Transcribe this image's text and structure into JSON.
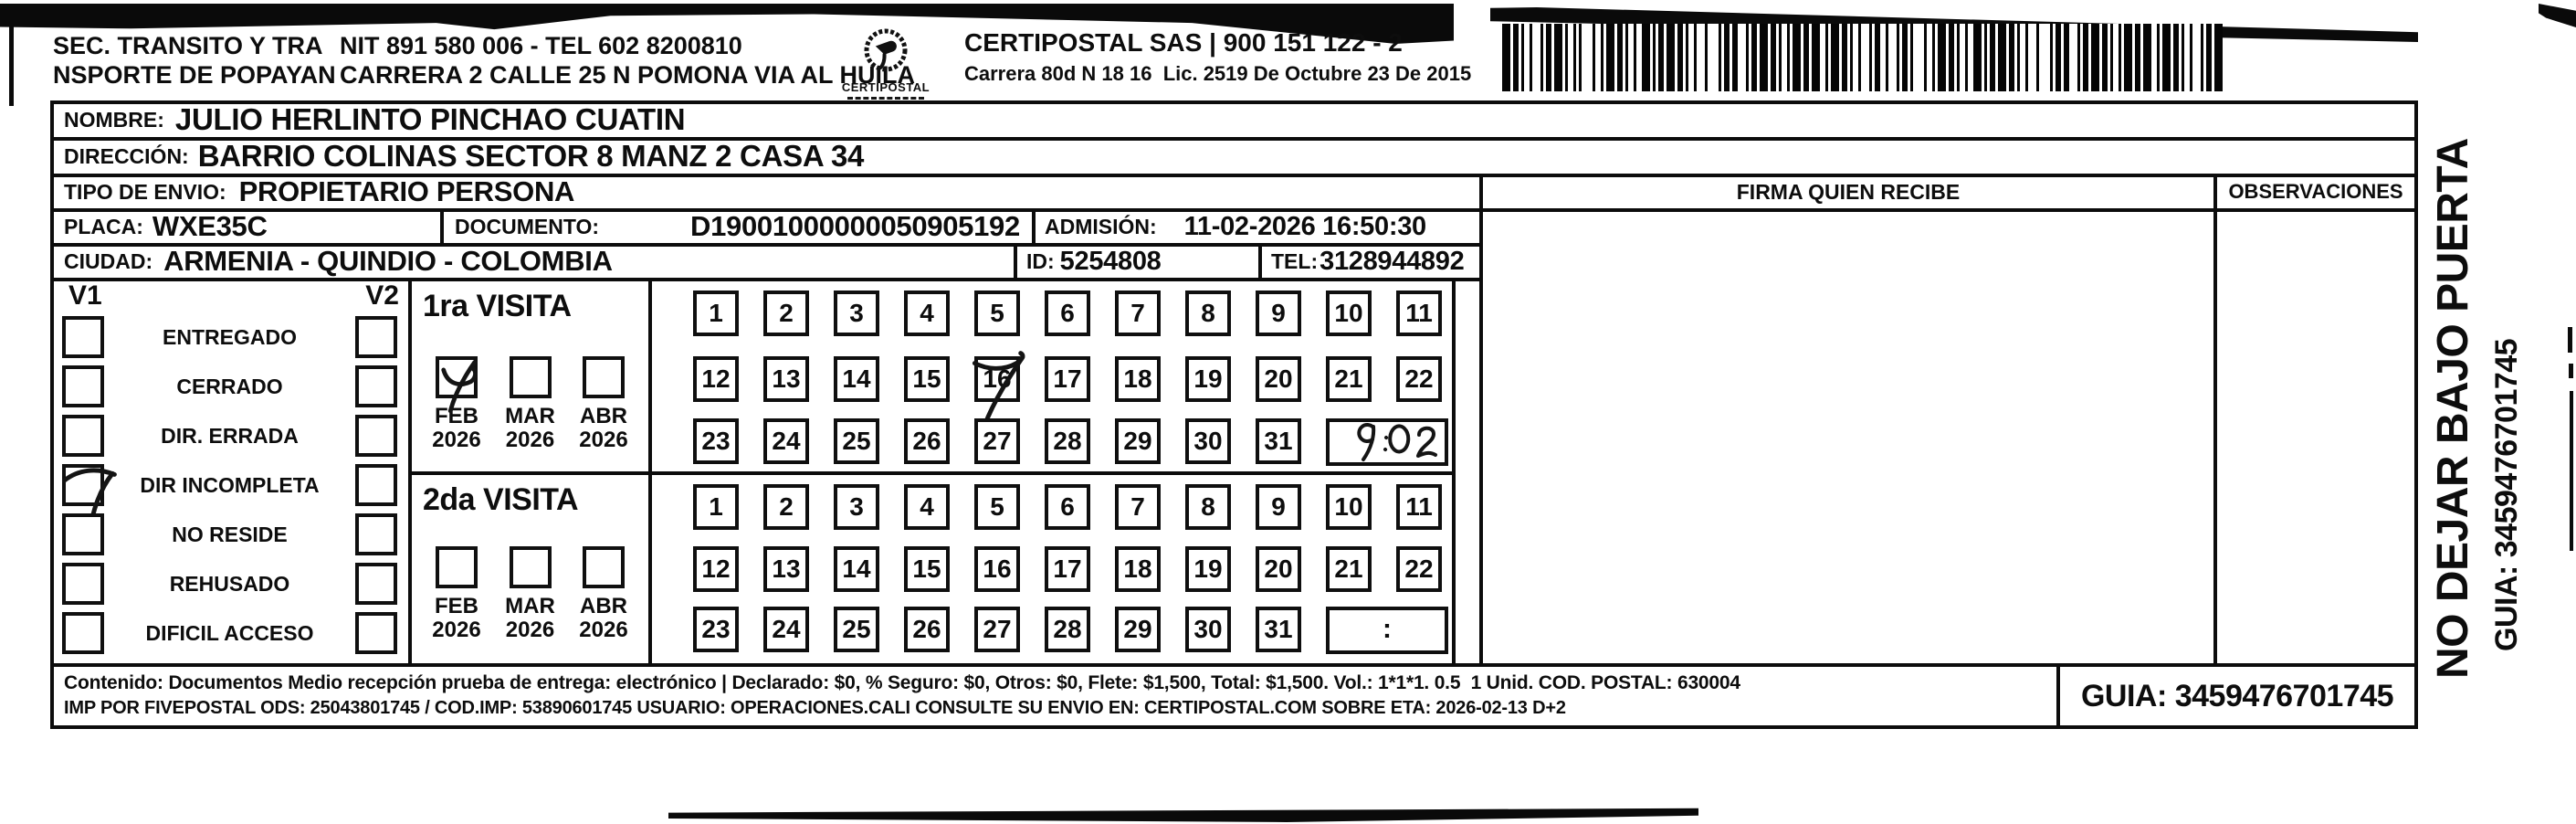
{
  "header": {
    "sender_name": "SEC. TRANSITO Y TRA\nNSPORTE DE POPAYAN",
    "sender_nit_tel": "NIT 891 580 006 - TEL 602 8200810",
    "sender_address": "CARRERA 2 CALLE 25 N POMONA VIA AL HUILA",
    "logo_text": "CERTIPOSTAL",
    "carrier_title": "CERTIPOSTAL SAS | 900 151 122 - 2",
    "carrier_address": "Carrera 80d N 18 16  Lic. 2519 De Octubre 23 De 2015"
  },
  "shipment": {
    "nombre_label": "NOMBRE:",
    "nombre": "JULIO HERLINTO PINCHAO CUATIN",
    "direccion_label": "DIRECCIÓN:",
    "direccion": "BARRIO COLINAS SECTOR 8 MANZ 2 CASA 34",
    "tipo_label": "TIPO DE ENVIO:",
    "tipo": "PROPIETARIO PERSONA",
    "placa_label": "PLACA:",
    "placa": "WXE35C",
    "documento_label": "DOCUMENTO:",
    "documento": "D19001000000050905192",
    "admision_label": "ADMISIÓN:",
    "admision": "11-02-2026 16:50:30",
    "ciudad_label": "CIUDAD:",
    "ciudad": "ARMENIA - QUINDIO - COLOMBIA",
    "id_label": "ID:",
    "id_value": "5254808",
    "tel_label": "TEL:",
    "tel": "3128944892"
  },
  "columns": {
    "firma": "FIRMA QUIEN RECIBE",
    "observaciones": "OBSERVACIONES"
  },
  "delivery_status": {
    "col1_header": "V1",
    "col2_header": "V2",
    "rows": [
      {
        "label": "ENTREGADO",
        "v1_marked": false,
        "v2_marked": false
      },
      {
        "label": "CERRADO",
        "v1_marked": false,
        "v2_marked": false
      },
      {
        "label": "DIR. ERRADA",
        "v1_marked": false,
        "v2_marked": false
      },
      {
        "label": "DIR INCOMPLETA",
        "v1_marked": true,
        "v2_marked": false
      },
      {
        "label": "NO RESIDE",
        "v1_marked": false,
        "v2_marked": false
      },
      {
        "label": "REHUSADO",
        "v1_marked": false,
        "v2_marked": false
      },
      {
        "label": "DIFICIL ACCESO",
        "v1_marked": false,
        "v2_marked": false
      }
    ]
  },
  "visits": [
    {
      "title": "1ra VISITA",
      "months": [
        {
          "month": "FEB",
          "year": "2026",
          "marked": true
        },
        {
          "month": "MAR",
          "year": "2026",
          "marked": false
        },
        {
          "month": "ABR",
          "year": "2026",
          "marked": false
        }
      ],
      "day_rows": [
        [
          1,
          2,
          3,
          4,
          5,
          6,
          7,
          8,
          9,
          10,
          11
        ],
        [
          12,
          13,
          14,
          15,
          16,
          17,
          18,
          19,
          20,
          21,
          22
        ],
        [
          23,
          24,
          25,
          26,
          27,
          28,
          29,
          30,
          31
        ]
      ],
      "marked_day": 16,
      "time_written": "9:02",
      "time_placeholder": ":"
    },
    {
      "title": "2da VISITA",
      "months": [
        {
          "month": "FEB",
          "year": "2026",
          "marked": false
        },
        {
          "month": "MAR",
          "year": "2026",
          "marked": false
        },
        {
          "month": "ABR",
          "year": "2026",
          "marked": false
        }
      ],
      "day_rows": [
        [
          1,
          2,
          3,
          4,
          5,
          6,
          7,
          8,
          9,
          10,
          11
        ],
        [
          12,
          13,
          14,
          15,
          16,
          17,
          18,
          19,
          20,
          21,
          22
        ],
        [
          23,
          24,
          25,
          26,
          27,
          28,
          29,
          30,
          31
        ]
      ],
      "marked_day": null,
      "time_written": "",
      "time_placeholder": ":"
    }
  ],
  "footer": {
    "content_line": "Contenido: Documentos Medio recepción prueba de entrega: electrónico | Declarado: $0, % Seguro: $0, Otros: $0, Flete: $1,500, Total: $1,500. Vol.: 1*1*1. 0.5  1 Unid. COD. POSTAL: 630004",
    "imp_line": "IMP POR FIVEPOSTAL ODS: 25043801745 / COD.IMP: 53890601745 USUARIO: OPERACIONES.CALI CONSULTE SU ENVIO EN: CERTIPOSTAL.COM SOBRE ETA: 2026-02-13 D+2",
    "guia": "GUIA: 3459476701745"
  },
  "side_note": {
    "line1": "NO DEJAR BAJO PUERTA",
    "line2": "GUIA: 3459476701745"
  }
}
